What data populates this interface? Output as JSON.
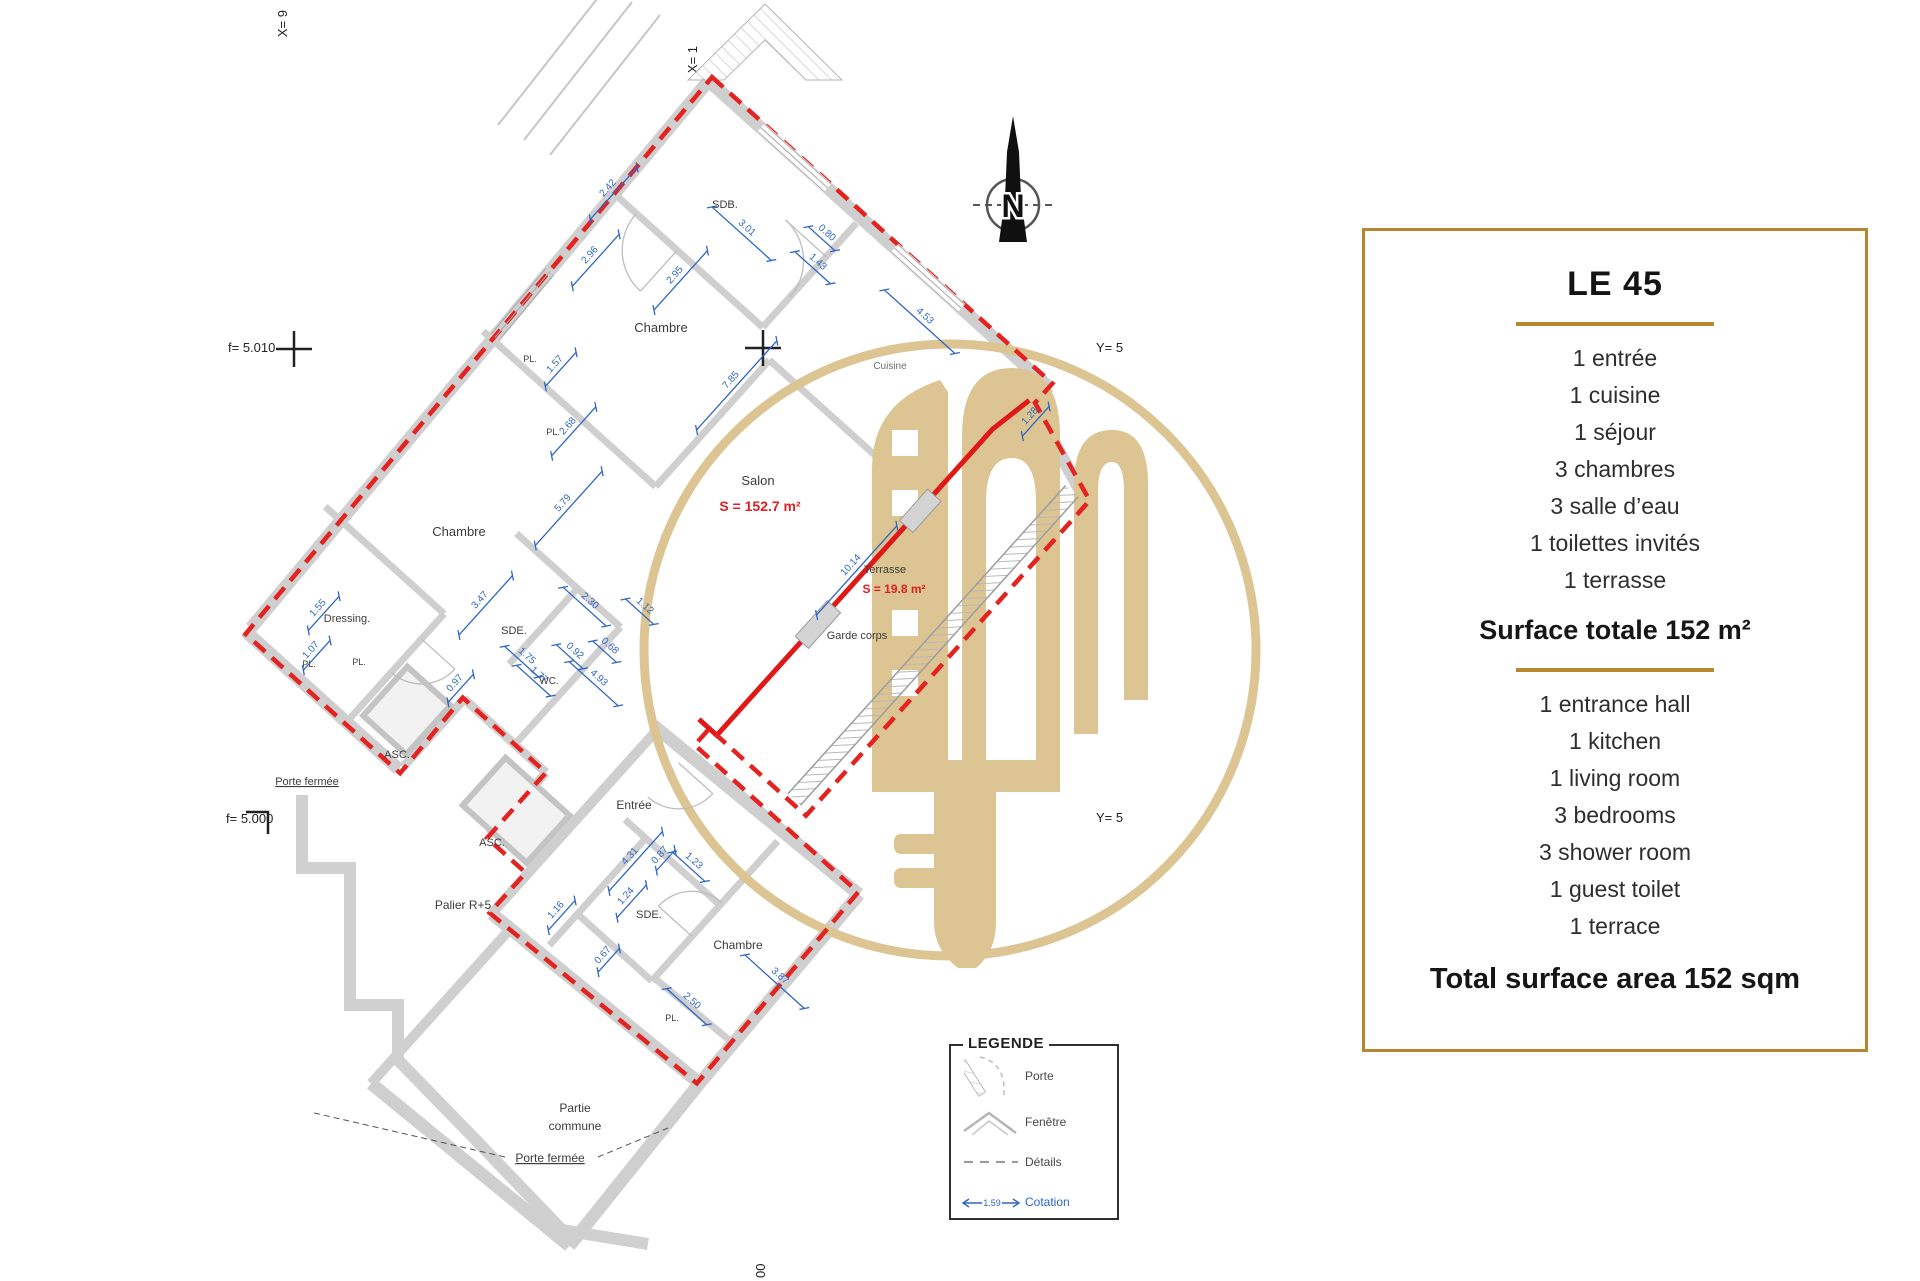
{
  "panel": {
    "title": "LE 45",
    "accent": "#b5872f",
    "fr_items": [
      "1 entrée",
      "1 cuisine",
      "1 séjour",
      "3 chambres",
      "3 salle d’eau",
      "1 toilettes invités",
      "1 terrasse"
    ],
    "fr_total": "Surface totale 152 m²",
    "en_items": [
      "1 entrance hall",
      "1 kitchen",
      "1 living room",
      "3 bedrooms",
      "3 shower room",
      "1 guest toilet",
      "1 terrace"
    ],
    "en_total": "Total surface area 152 sqm"
  },
  "legend": {
    "title": "LEGENDE",
    "items": [
      {
        "label": "Porte"
      },
      {
        "label": "Fenêtre"
      },
      {
        "label": "Détails"
      },
      {
        "label": "Cotation",
        "value": "1.59"
      }
    ]
  },
  "compass": {
    "letter": "N"
  },
  "markers": {
    "top_left": "X= 9",
    "top_right": "X= 1",
    "bottom": "00",
    "left_upper": "f= 5.010",
    "left_lower": "f= 5.000",
    "right_upper": "Y= 5",
    "right_lower": "Y= 5"
  },
  "plan": {
    "colors": {
      "wall": "#cfcfcf",
      "wall_edge": "#9a9a9a",
      "boundary": "#e42320",
      "red_wall": "#e01818",
      "dim": "#2f66c4",
      "label": "#3c3c3c",
      "gray_label": "#6f6f6f",
      "area": "#e02020",
      "watermark": "#dcc593"
    },
    "labels": [
      {
        "t": "SDB.",
        "x": 725,
        "y": 208,
        "fs": 11
      },
      {
        "t": "Chambre",
        "x": 661,
        "y": 332,
        "fs": 13
      },
      {
        "t": "Cuisine",
        "x": 890,
        "y": 369,
        "fs": 10,
        "c": "gray"
      },
      {
        "t": "Chambre",
        "x": 459,
        "y": 536,
        "fs": 13
      },
      {
        "t": "Dressing.",
        "x": 347,
        "y": 622,
        "fs": 11
      },
      {
        "t": "SDE.",
        "x": 514,
        "y": 634,
        "fs": 11
      },
      {
        "t": "WC.",
        "x": 549,
        "y": 684,
        "fs": 10
      },
      {
        "t": "Salon",
        "x": 758,
        "y": 485,
        "fs": 13
      },
      {
        "t": "Terrasse",
        "x": 885,
        "y": 573,
        "fs": 11
      },
      {
        "t": "Garde corps",
        "x": 857,
        "y": 639,
        "fs": 11
      },
      {
        "t": "ASC.",
        "x": 397,
        "y": 758,
        "fs": 11
      },
      {
        "t": "Porte fermée",
        "x": 307,
        "y": 785,
        "fs": 11,
        "u": 1
      },
      {
        "t": "ASC.",
        "x": 492,
        "y": 846,
        "fs": 11
      },
      {
        "t": "Palier R+5",
        "x": 463,
        "y": 909,
        "fs": 12
      },
      {
        "t": "Entrée",
        "x": 634,
        "y": 809,
        "fs": 12
      },
      {
        "t": "SDE.",
        "x": 649,
        "y": 918,
        "fs": 11
      },
      {
        "t": "Chambre",
        "x": 738,
        "y": 949,
        "fs": 12
      },
      {
        "t": "PL.",
        "x": 672,
        "y": 1021,
        "fs": 9
      },
      {
        "t": "Partie",
        "x": 575,
        "y": 1112,
        "fs": 12
      },
      {
        "t": "commune",
        "x": 575,
        "y": 1130,
        "fs": 12
      },
      {
        "t": "Porte fermée",
        "x": 550,
        "y": 1162,
        "fs": 12,
        "u": 1
      },
      {
        "t": "PL.",
        "x": 530,
        "y": 362,
        "fs": 9
      },
      {
        "t": "PL.",
        "x": 553,
        "y": 435,
        "fs": 9
      },
      {
        "t": "PL.",
        "x": 309,
        "y": 667,
        "fs": 9
      },
      {
        "t": "PL.",
        "x": 359,
        "y": 665,
        "fs": 9
      }
    ],
    "area_labels": [
      {
        "t": "S = 152.7 m²",
        "x": 760,
        "y": 511,
        "fs": 14
      },
      {
        "t": "S = 19.8 m²",
        "x": 894,
        "y": 593,
        "fs": 12
      }
    ],
    "dims": [
      {
        "t": "2.42",
        "x": 610,
        "y": 190,
        "r": -48,
        "l": 70
      },
      {
        "t": "3.01",
        "x": 745,
        "y": 230,
        "r": 42,
        "l": 80
      },
      {
        "t": "2.96",
        "x": 592,
        "y": 257,
        "r": -48,
        "l": 70
      },
      {
        "t": "2.95",
        "x": 677,
        "y": 277,
        "r": -48,
        "l": 80
      },
      {
        "t": "7.85",
        "x": 733,
        "y": 382,
        "r": -48,
        "l": 120
      },
      {
        "t": "1.57",
        "x": 557,
        "y": 366,
        "r": -48,
        "l": 46
      },
      {
        "t": "2.68",
        "x": 570,
        "y": 428,
        "r": -48,
        "l": 66
      },
      {
        "t": "0.80",
        "x": 825,
        "y": 235,
        "r": 42,
        "l": 36
      },
      {
        "t": "1.43",
        "x": 816,
        "y": 264,
        "r": 42,
        "l": 48
      },
      {
        "t": "4.53",
        "x": 923,
        "y": 318,
        "r": 42,
        "l": 95
      },
      {
        "t": "5.79",
        "x": 565,
        "y": 505,
        "r": -48,
        "l": 100
      },
      {
        "t": "1.55",
        "x": 320,
        "y": 610,
        "r": -48,
        "l": 46
      },
      {
        "t": "1.07",
        "x": 313,
        "y": 652,
        "r": -48,
        "l": 40
      },
      {
        "t": "3.47",
        "x": 482,
        "y": 602,
        "r": -48,
        "l": 80
      },
      {
        "t": "2.30",
        "x": 588,
        "y": 603,
        "r": 42,
        "l": 58
      },
      {
        "t": "1.12",
        "x": 643,
        "y": 608,
        "r": 42,
        "l": 38
      },
      {
        "t": "1.75",
        "x": 525,
        "y": 658,
        "r": 42,
        "l": 46
      },
      {
        "t": "1.77",
        "x": 537,
        "y": 677,
        "r": 42,
        "l": 46
      },
      {
        "t": "0.92",
        "x": 573,
        "y": 653,
        "r": 42,
        "l": 36
      },
      {
        "t": "0.68",
        "x": 608,
        "y": 648,
        "r": 42,
        "l": 32
      },
      {
        "t": "0.97",
        "x": 457,
        "y": 685,
        "r": -48,
        "l": 38
      },
      {
        "t": "4.93",
        "x": 597,
        "y": 680,
        "r": 42,
        "l": 66
      },
      {
        "t": "10.14",
        "x": 853,
        "y": 567,
        "r": -48,
        "l": 120
      },
      {
        "t": "1.28",
        "x": 1032,
        "y": 418,
        "r": -48,
        "l": 40
      },
      {
        "t": "4.31",
        "x": 632,
        "y": 858,
        "r": -48,
        "l": 80
      },
      {
        "t": "0.87",
        "x": 662,
        "y": 857,
        "r": -48,
        "l": 28
      },
      {
        "t": "1.23",
        "x": 692,
        "y": 863,
        "r": 42,
        "l": 44
      },
      {
        "t": "1.24",
        "x": 628,
        "y": 898,
        "r": -48,
        "l": 44
      },
      {
        "t": "1.16",
        "x": 558,
        "y": 912,
        "r": -48,
        "l": 40
      },
      {
        "t": "0.67",
        "x": 605,
        "y": 957,
        "r": -48,
        "l": 32
      },
      {
        "t": "2.50",
        "x": 690,
        "y": 1003,
        "r": 42,
        "l": 54
      },
      {
        "t": "3.87",
        "x": 778,
        "y": 978,
        "r": 42,
        "l": 80
      }
    ]
  }
}
